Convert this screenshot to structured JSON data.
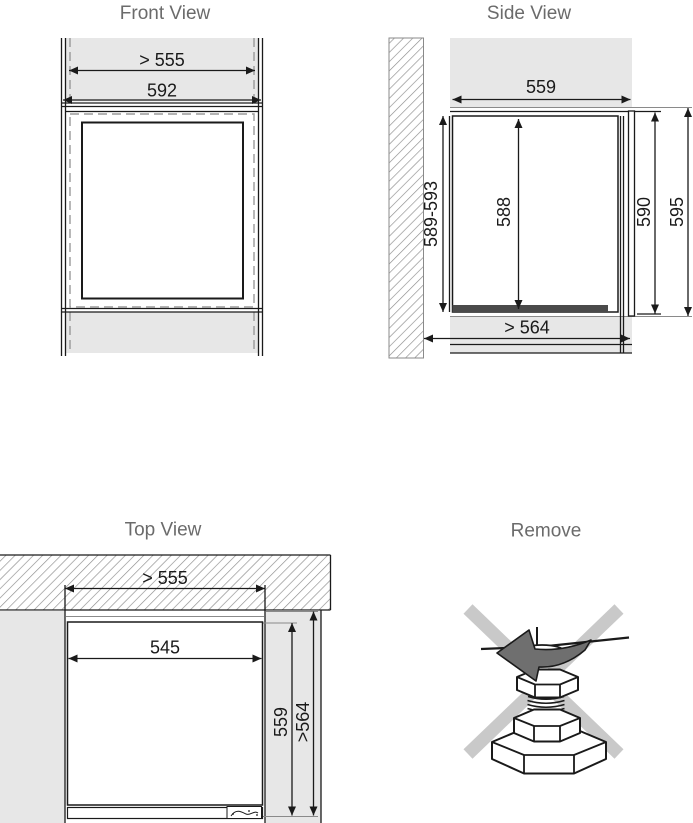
{
  "front_view": {
    "title": "Front View",
    "dim_min_niche_width": "> 555",
    "dim_overall_width": "592"
  },
  "side_view": {
    "title": "Side View",
    "dim_top_depth": "559",
    "dim_niche_height": "589-593",
    "dim_body_height": "588",
    "dim_door_height": "590",
    "dim_overall_height": "595",
    "dim_min_bottom_depth": "> 564"
  },
  "top_view": {
    "title": "Top View",
    "dim_min_niche_width": "> 555",
    "dim_body_width": "545",
    "dim_body_depth": "559",
    "dim_min_niche_depth": ">564"
  },
  "remove_view": {
    "title": "Remove"
  },
  "colors": {
    "panel_gray": "#e7e7e7",
    "line_black": "#1a1a1a",
    "dashed_gray": "#9a9a9a",
    "hatch_gray": "#8c8c8c",
    "dark_bar": "#4a4a4a",
    "title_text": "#6b6b6b",
    "cross_gray": "#c9c9c9",
    "arrow_gray": "#6f6f6f"
  }
}
